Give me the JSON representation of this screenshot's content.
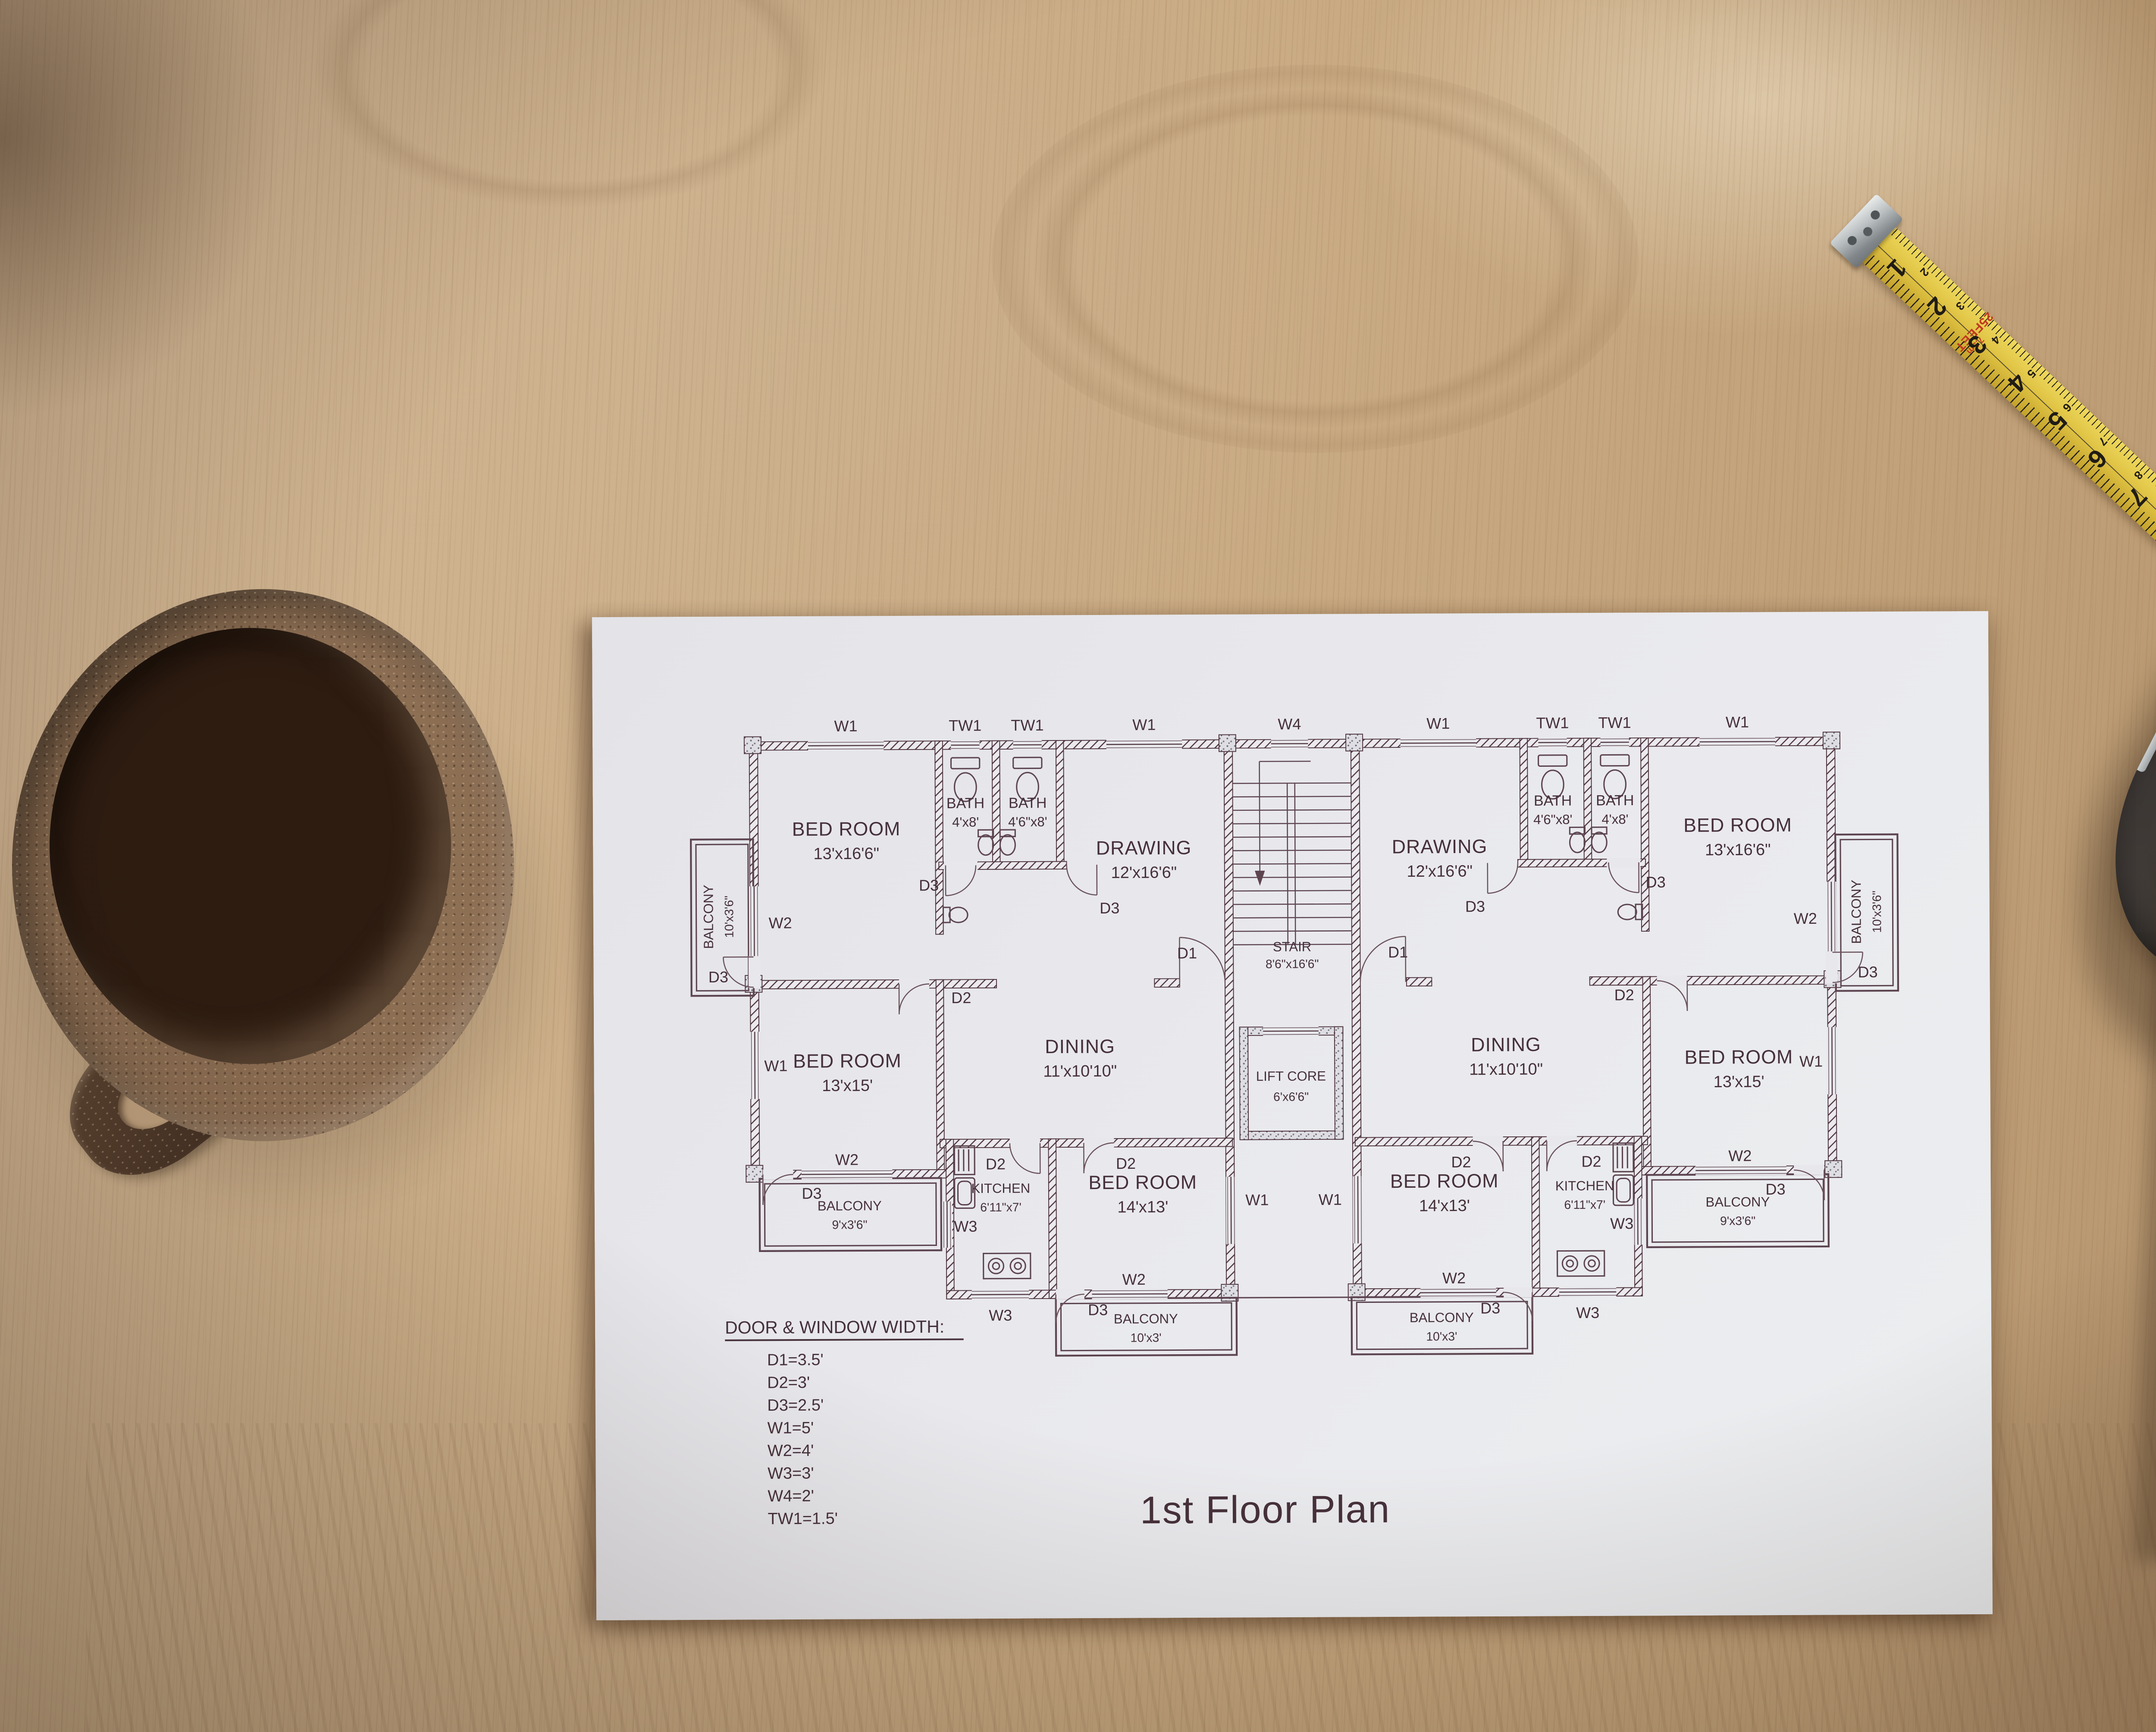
{
  "plan": {
    "title": "1st Floor Plan",
    "legend": {
      "heading": "DOOR & WINDOW WIDTH:",
      "items": [
        "D1=3.5'",
        "D2=3'",
        "D3=2.5'",
        "W1=5'",
        "W2=4'",
        "W3=3'",
        "W4=2'",
        "TW1=1.5'"
      ]
    },
    "rooms": [
      {
        "name": "BED ROOM",
        "size": "13'x16'6\""
      },
      {
        "name": "BATH",
        "size": "4'x8'"
      },
      {
        "name": "BATH",
        "size": "4'6\"x8'"
      },
      {
        "name": "DRAWING",
        "size": "12'x16'6\""
      },
      {
        "name": "STAIR",
        "size": "8'6\"x16'6\""
      },
      {
        "name": "DRAWING",
        "size": "12'x16'6\""
      },
      {
        "name": "BATH",
        "size": "4'6\"x8'"
      },
      {
        "name": "BATH",
        "size": "4'x8'"
      },
      {
        "name": "BED ROOM",
        "size": "13'x16'6\""
      },
      {
        "name": "BALCONY",
        "size": "10'x3'6\""
      },
      {
        "name": "BALCONY",
        "size": "10'x3'6\""
      },
      {
        "name": "BED ROOM",
        "size": "13'x15'"
      },
      {
        "name": "DINING",
        "size": "11'x10'10\""
      },
      {
        "name": "LIFT CORE",
        "size": "6'x6'6\""
      },
      {
        "name": "DINING",
        "size": "11'x10'10\""
      },
      {
        "name": "BED ROOM",
        "size": "13'x15'"
      },
      {
        "name": "BALCONY",
        "size": "9'x3'6\""
      },
      {
        "name": "BALCONY",
        "size": "9'x3'6\""
      },
      {
        "name": "KITCHEN",
        "size": "6'11\"x7'"
      },
      {
        "name": "BED ROOM",
        "size": "14'x13'"
      },
      {
        "name": "BED ROOM",
        "size": "14'x13'"
      },
      {
        "name": "KITCHEN",
        "size": "6'11\"x7'"
      },
      {
        "name": "BALCONY",
        "size": "10'x3'"
      },
      {
        "name": "BALCONY",
        "size": "10'x3'"
      }
    ],
    "tags": [
      "W1",
      "TW1",
      "TW1",
      "W1",
      "W4",
      "W1",
      "TW1",
      "TW1",
      "W1",
      "W2",
      "D3",
      "W1",
      "D3",
      "D3",
      "D2",
      "D1",
      "D1",
      "D2",
      "D3",
      "D3",
      "W1",
      "W2",
      "D3",
      "W2",
      "D3",
      "W3",
      "W1",
      "W1",
      "W3",
      "D3",
      "W2",
      "D2",
      "D2",
      "D2",
      "D2",
      "W2",
      "W3",
      "D3",
      "D3",
      "W3",
      "W2"
    ]
  },
  "tape": {
    "label_feet": "25FEET",
    "label_m": "7.5m",
    "inch_numbers": [
      "1",
      "2",
      "3",
      "4",
      "5",
      "6",
      "7",
      "8"
    ],
    "cm_numbers": [
      "2",
      "3",
      "4",
      "5",
      "6",
      "7",
      "8",
      "9"
    ]
  },
  "colors": {
    "wood": "#c8a981",
    "paper": "#e9e9ed",
    "ink": "#4e353e",
    "tape_yellow": "#dfc243",
    "tape_red": "#c04b2b",
    "tape_gray": "#8d867c",
    "coffee": "#1f130d",
    "mug_rim": "#8d6f54",
    "pencil_body": "#4a4643"
  }
}
